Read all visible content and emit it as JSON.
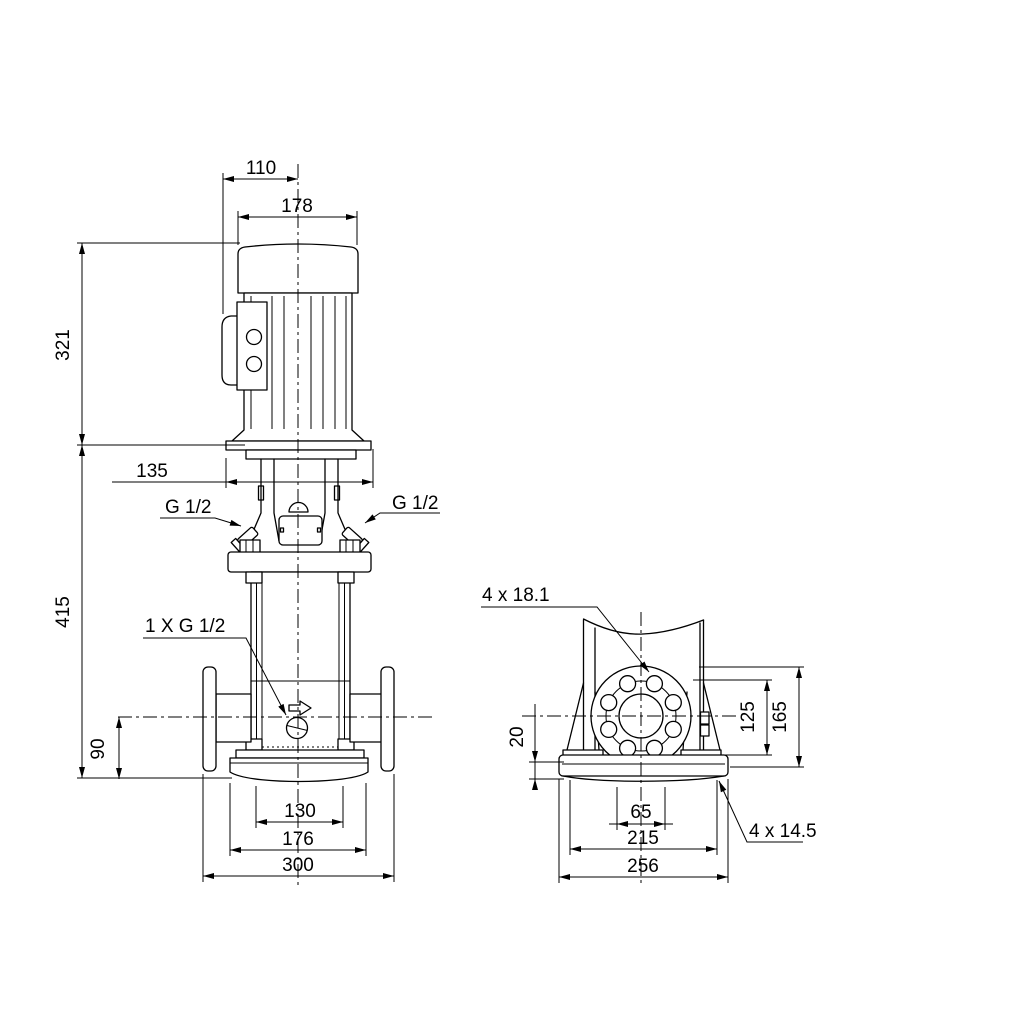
{
  "front_view": {
    "dims": {
      "motor_face_to_center": "110",
      "motor_width": "178",
      "motor_height": "321",
      "motor_flange_width": "135",
      "pump_height": "415",
      "port_center_height": "90",
      "base_hole_spacing": "130",
      "base_width": "176",
      "port_to_port": "300"
    },
    "labels": {
      "plug_left": "G 1/2",
      "plug_right": "G 1/2",
      "drain_plug": "1 X G 1/2"
    }
  },
  "side_view": {
    "dims": {
      "base_plate_thickness": "20",
      "flange_bolt_height": "125",
      "flange_top_height": "165",
      "base_slot_spacing": "65",
      "base_hole_spacing": "215",
      "base_length": "256"
    },
    "labels": {
      "flange_holes": "4 x 18.1",
      "base_holes": "4 x 14.5"
    }
  }
}
